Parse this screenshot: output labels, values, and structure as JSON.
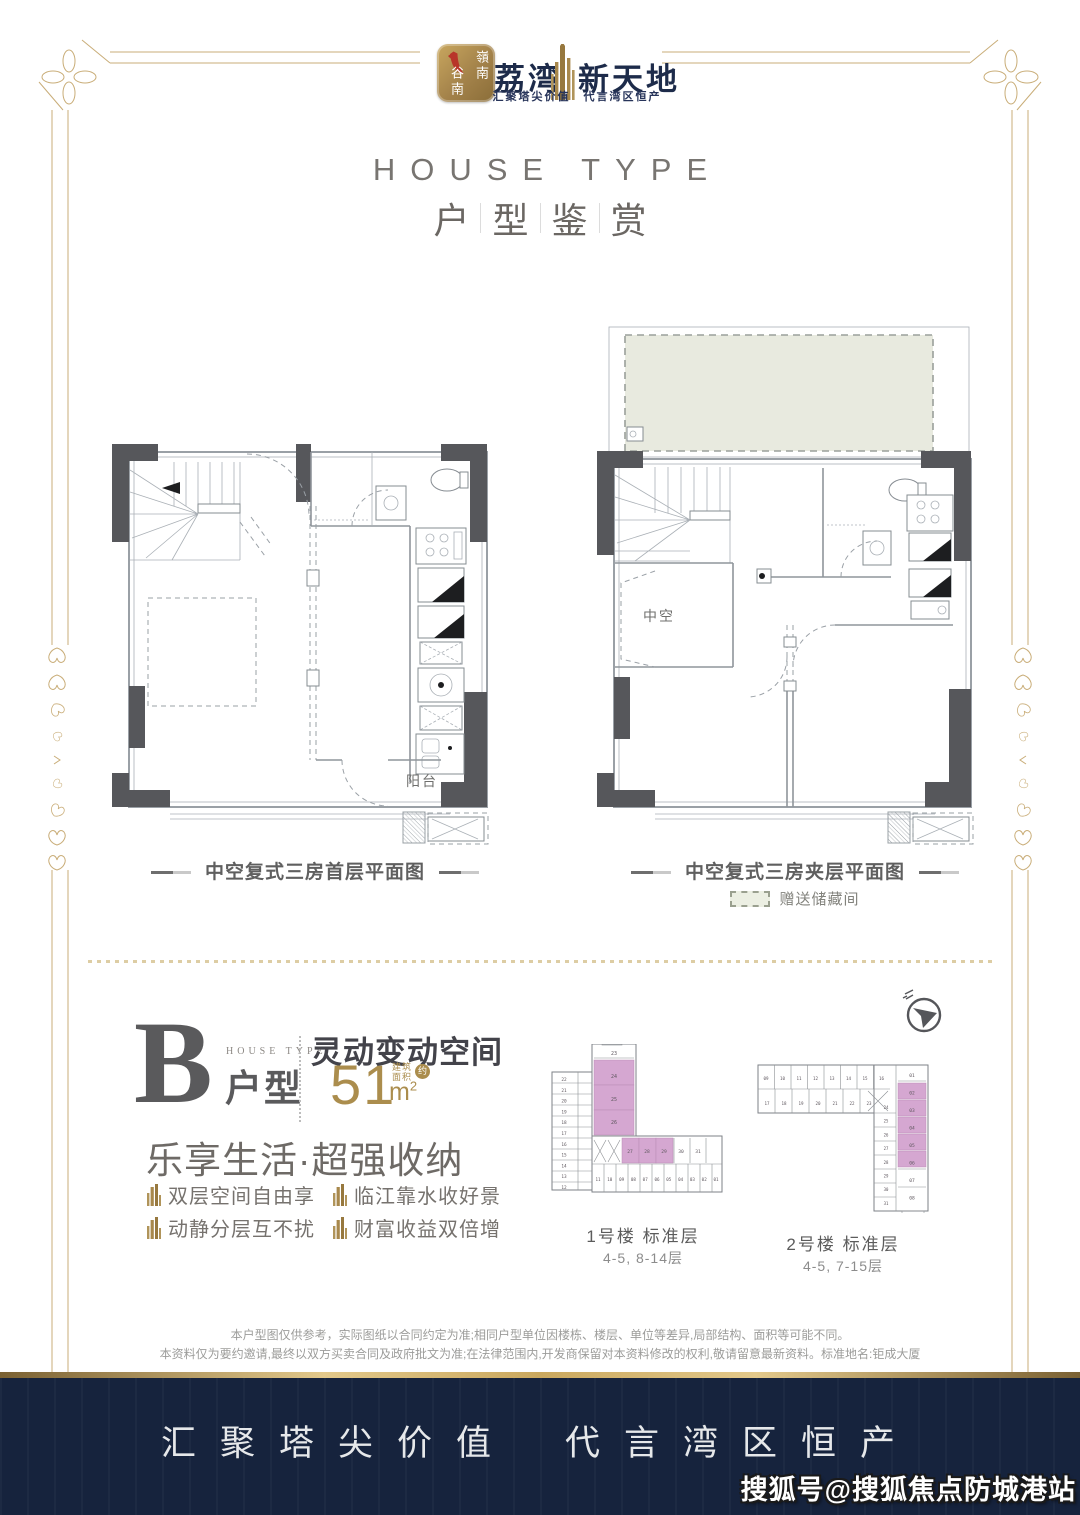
{
  "colors": {
    "frame_gold": "#c9ad78",
    "brand_navy": "#1d2b4a",
    "logo_gold": "#a8884c",
    "accent_gold": "#ab8d4d",
    "heading_gray": "#6b6763",
    "plan_line": "#9aa0a6",
    "plan_column": "#56575b",
    "storage_fill": "#e8eadf",
    "unit_highlight_pink": "#d5a7d1",
    "footer_navy": "#16233d"
  },
  "header": {
    "badge_line1": "嶺南",
    "badge_line2": "谷南",
    "brand_left": "荔湾",
    "brand_right": "新天地",
    "tagline": "汇聚塔尖价值　代言湾区恒产"
  },
  "title": {
    "en": "HOUSE TYPE",
    "zh_chars": [
      "户",
      "型",
      "鉴",
      "赏"
    ]
  },
  "plans": {
    "left": {
      "caption": "中空复式三房首层平面图",
      "balcony_label": "阳台"
    },
    "right": {
      "caption": "中空复式三房夹层平面图",
      "void_label": "中空",
      "legend": "赠送储藏间"
    }
  },
  "unit": {
    "letter": "B",
    "type_en": "HOUSE TYPE",
    "type_zh": "户型",
    "slogan": "灵动变动空间",
    "area_value": "51",
    "area_note_1": "建筑",
    "area_note_2": "面积",
    "area_approx": "约",
    "subtitle": "乐享生活·超强收纳",
    "features": [
      "双层空间自由享",
      "临江靠水收好景",
      "动静分层互不扰",
      "财富收益双倍增"
    ]
  },
  "towers": [
    {
      "name": "1号楼 标准层",
      "floors": "4-5, 8-14层",
      "stem_units": [
        "23",
        "24",
        "25",
        "26"
      ],
      "wing_units": [
        "22",
        "21",
        "20",
        "19",
        "18",
        "17",
        "16",
        "15",
        "14",
        "13",
        "12"
      ],
      "mid_units": [
        "27",
        "28",
        "29",
        "30",
        "31"
      ],
      "bottom_units": [
        "11",
        "10",
        "09",
        "08",
        "07",
        "06",
        "05",
        "04",
        "03",
        "02",
        "01"
      ],
      "highlighted_units": [
        "24",
        "25",
        "26",
        "27",
        "28",
        "29"
      ]
    },
    {
      "name": "2号楼 标准层",
      "floors": "4-5, 7-15层",
      "top_units": [
        "09",
        "10",
        "11",
        "12",
        "13",
        "14",
        "15",
        "16"
      ],
      "second_units": [
        "17",
        "18",
        "19",
        "20",
        "21",
        "22",
        "23"
      ],
      "stem_left_units": [
        "24",
        "25",
        "26",
        "27",
        "28",
        "29",
        "30",
        "31"
      ],
      "stem_right_units": [
        "01",
        "02",
        "03",
        "04",
        "05",
        "06",
        "07",
        "08"
      ],
      "highlighted_units": [
        "02",
        "03",
        "04",
        "05",
        "06"
      ]
    }
  ],
  "disclaimer": [
    "本户型图仅供参考，实际图纸以合同约定为准;相同户型单位因楼栋、楼层、单位等差异,局部结构、面积等可能不同。",
    "本资料仅为要约邀请,最终以双方买卖合同及政府批文为准;在法律范围内,开发商保留对本资料修改的权利,敬请留意最新资料。标准地名:钜成大厦"
  ],
  "footer": {
    "slogan_left": "汇聚塔尖价值",
    "slogan_right": "代言湾区恒产",
    "watermark": "搜狐号@搜狐焦点防城港站"
  }
}
